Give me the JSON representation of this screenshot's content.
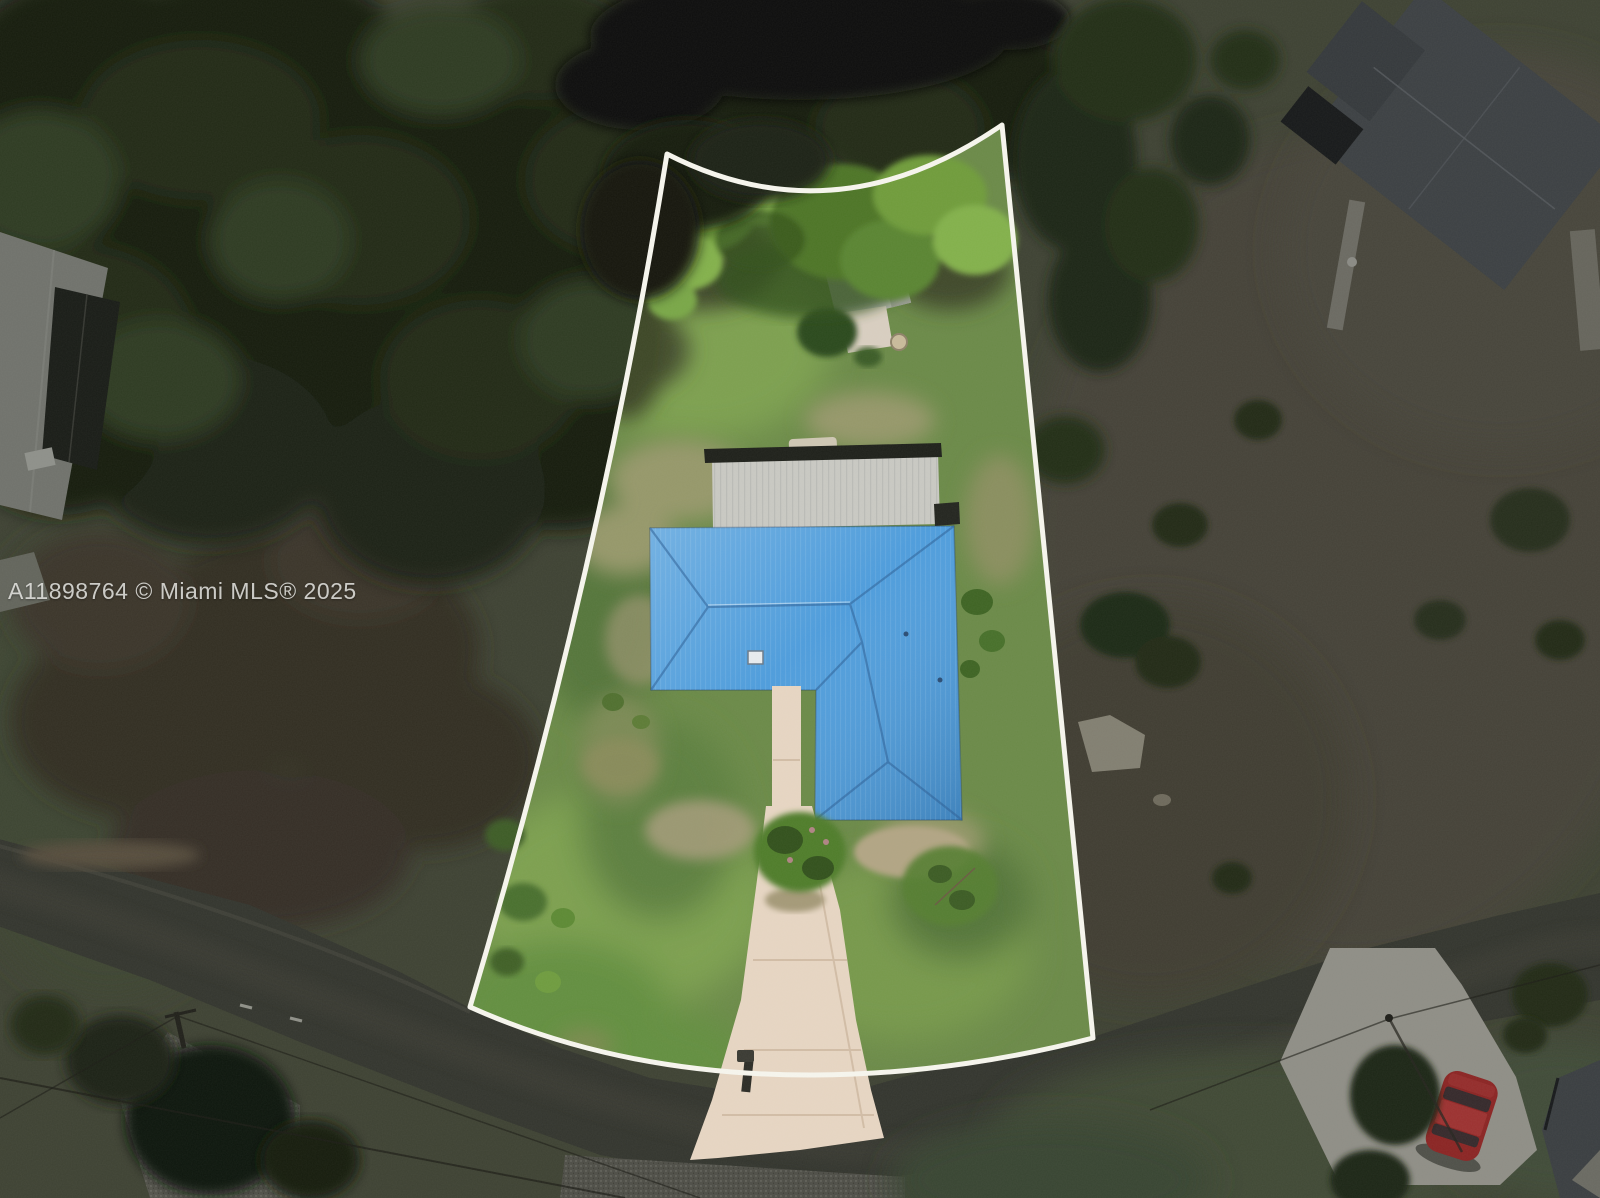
{
  "watermark": {
    "text": "A11898764 © Miami MLS® 2025",
    "color": "rgba(238,238,234,0.82)"
  },
  "colors": {
    "dim_ground": "#3e4233",
    "forest_dark": "#161c10",
    "road": "#33352e",
    "lot_grass": "#6b8a48",
    "boundary_line": "#f7f6ee",
    "roof_blue": "#4a9bdc",
    "lanai_gray": "#c9c9c3",
    "shed_gray": "#b3b5ae",
    "driveway_concrete": "#e7d6c3",
    "neighbor_roof_gray": "#3c4043",
    "car_red": "#8b2423"
  },
  "scene": {
    "label": "aerial-view-of-highlighted-property-lot-with-blue-roof-house"
  }
}
